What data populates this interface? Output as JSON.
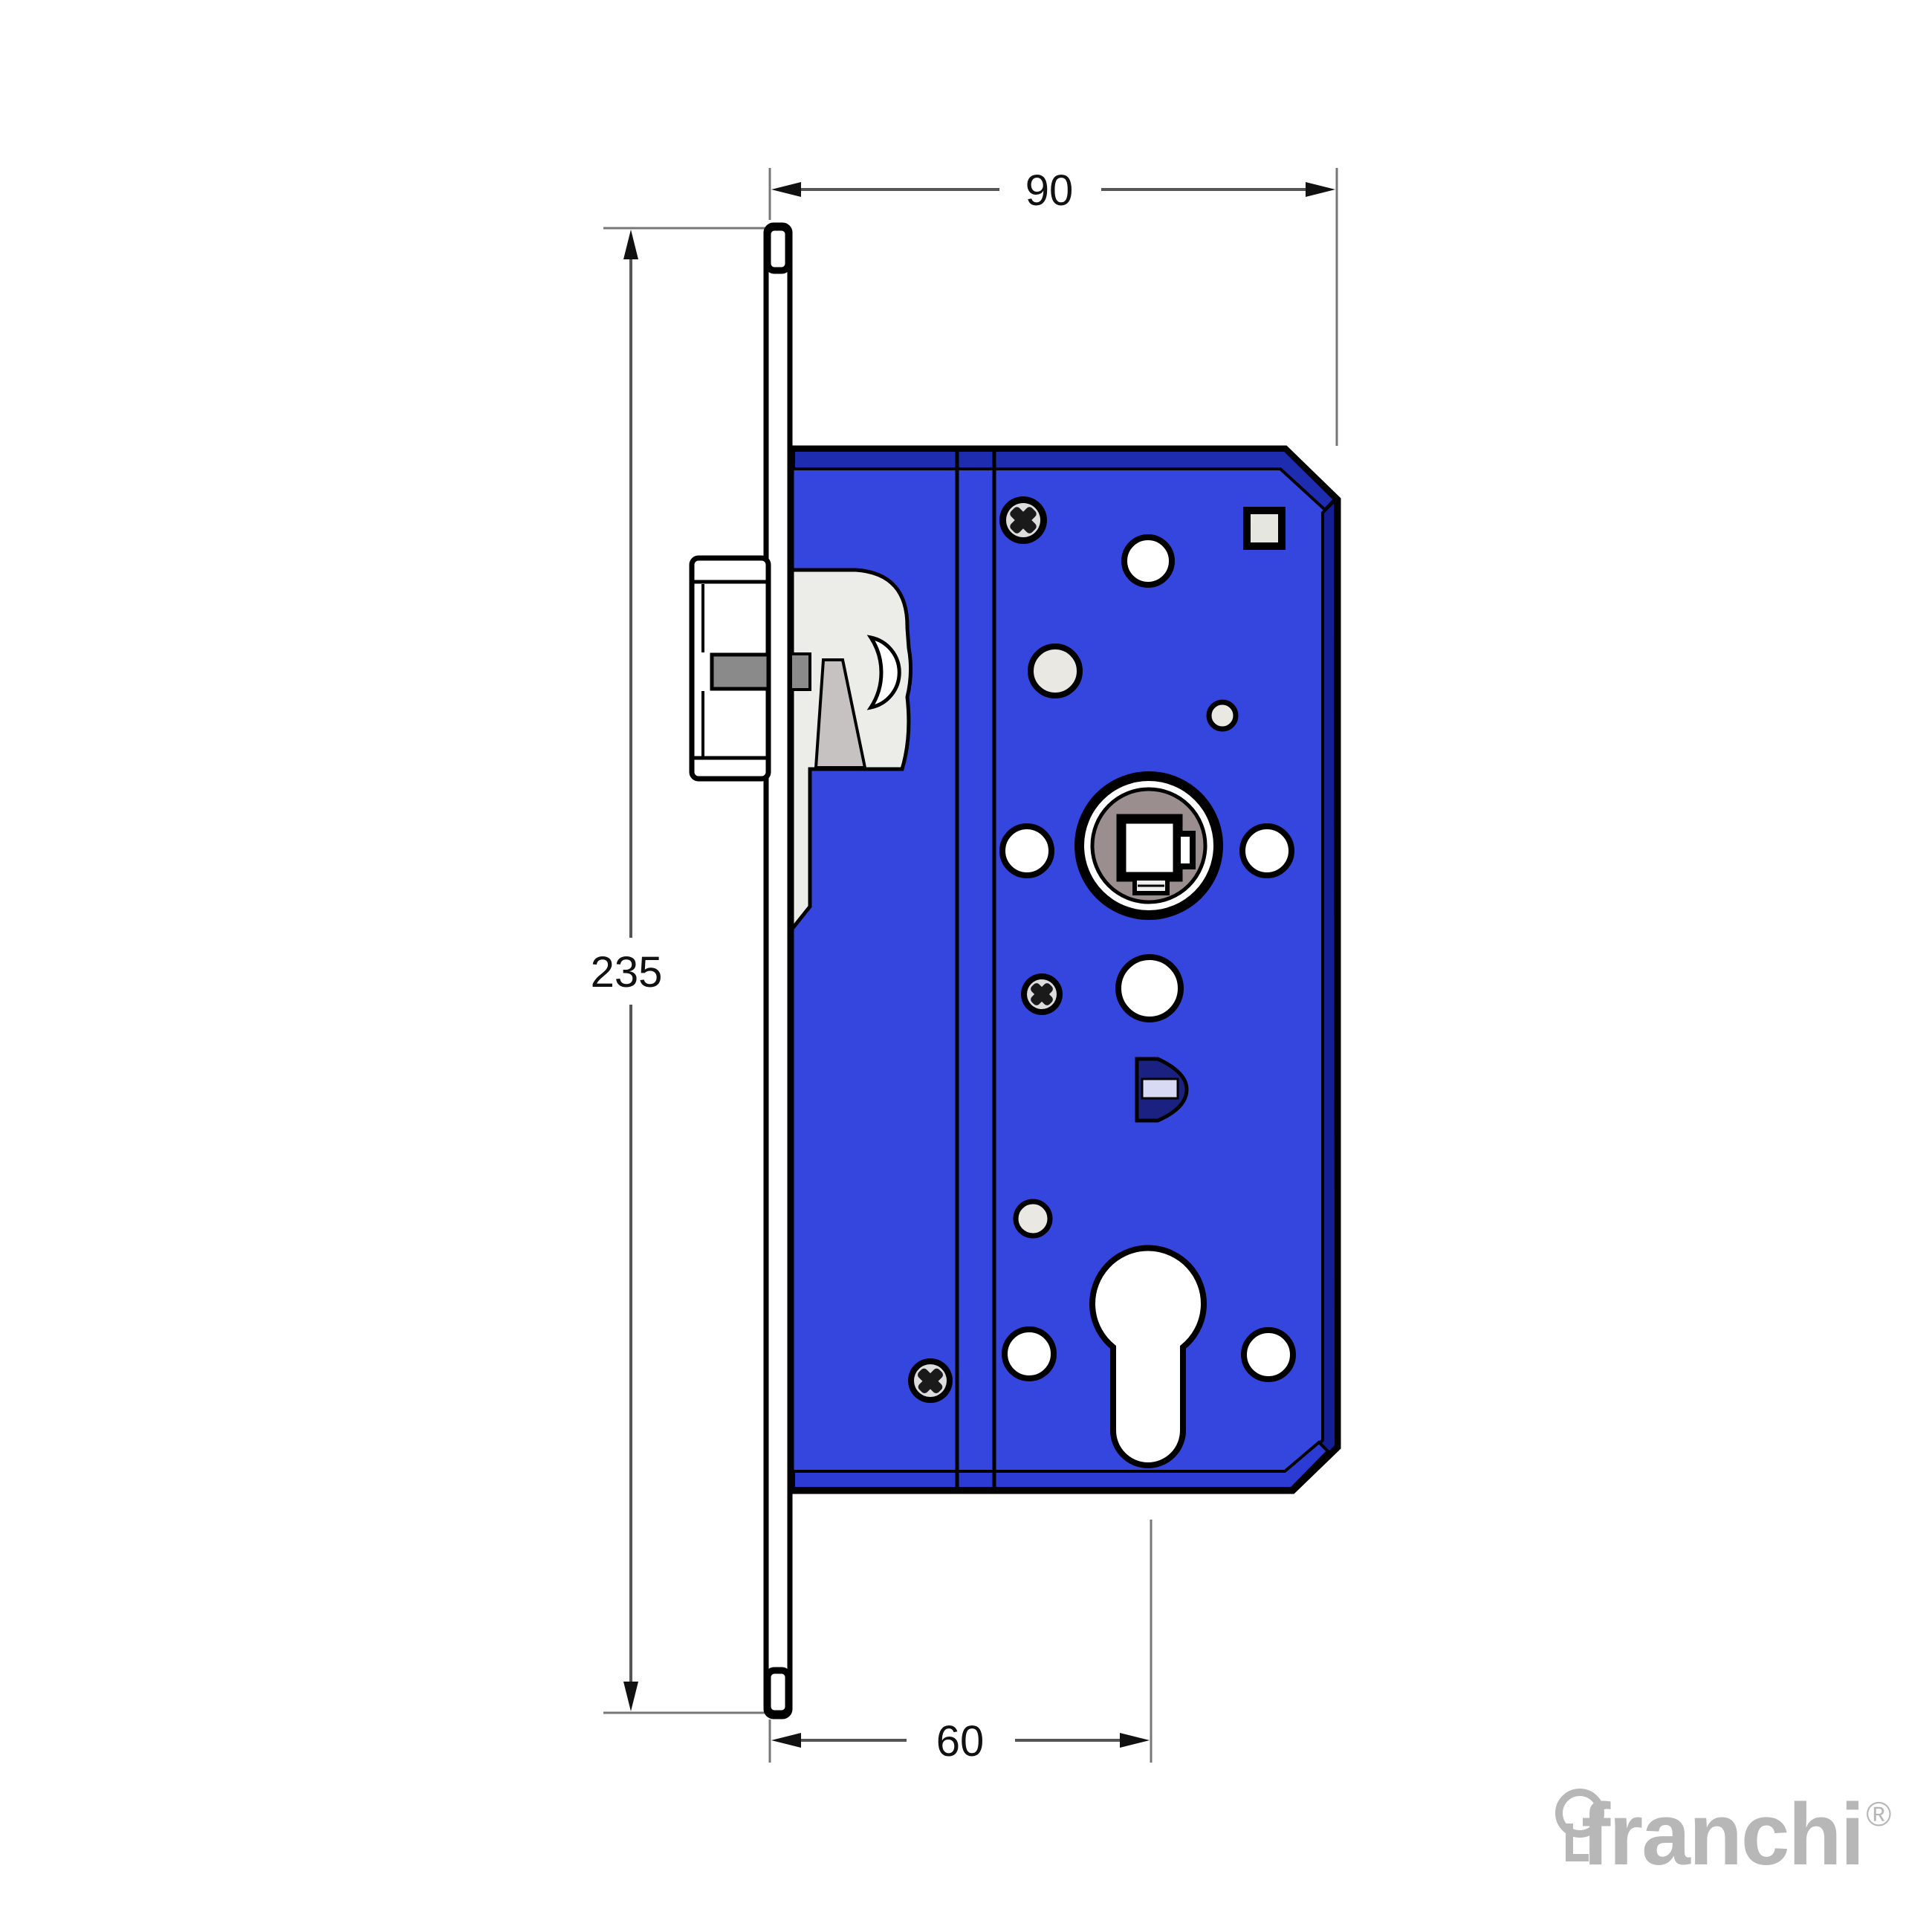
{
  "dimensions": {
    "width_mm": "90",
    "height_mm": "235",
    "backset_mm": "60"
  },
  "logo": {
    "brand": "franchi",
    "registered_mark": "®"
  },
  "colors": {
    "background": "#ffffff",
    "body_blue": "#3546df",
    "body_fold_top": "#1e2cb0",
    "body_fold_right": "#141f96",
    "body_fold_bottom": "#2b3bd4",
    "outline_black": "#000000",
    "hub_disc_taupe": "#9b8e8e",
    "latch_band_gray": "#8a8a8a",
    "wedge_gray": "#c6c2c2",
    "cutout_gray": "#ecece8",
    "hole_white": "#ffffff",
    "hole_light_gray": "#e9e8e2",
    "locking_pin_navy": "#1b2180",
    "locking_pin_band": "#d8daf4",
    "dimension_line_gray": "#555555",
    "logo_gray": "#b7b7b7"
  }
}
